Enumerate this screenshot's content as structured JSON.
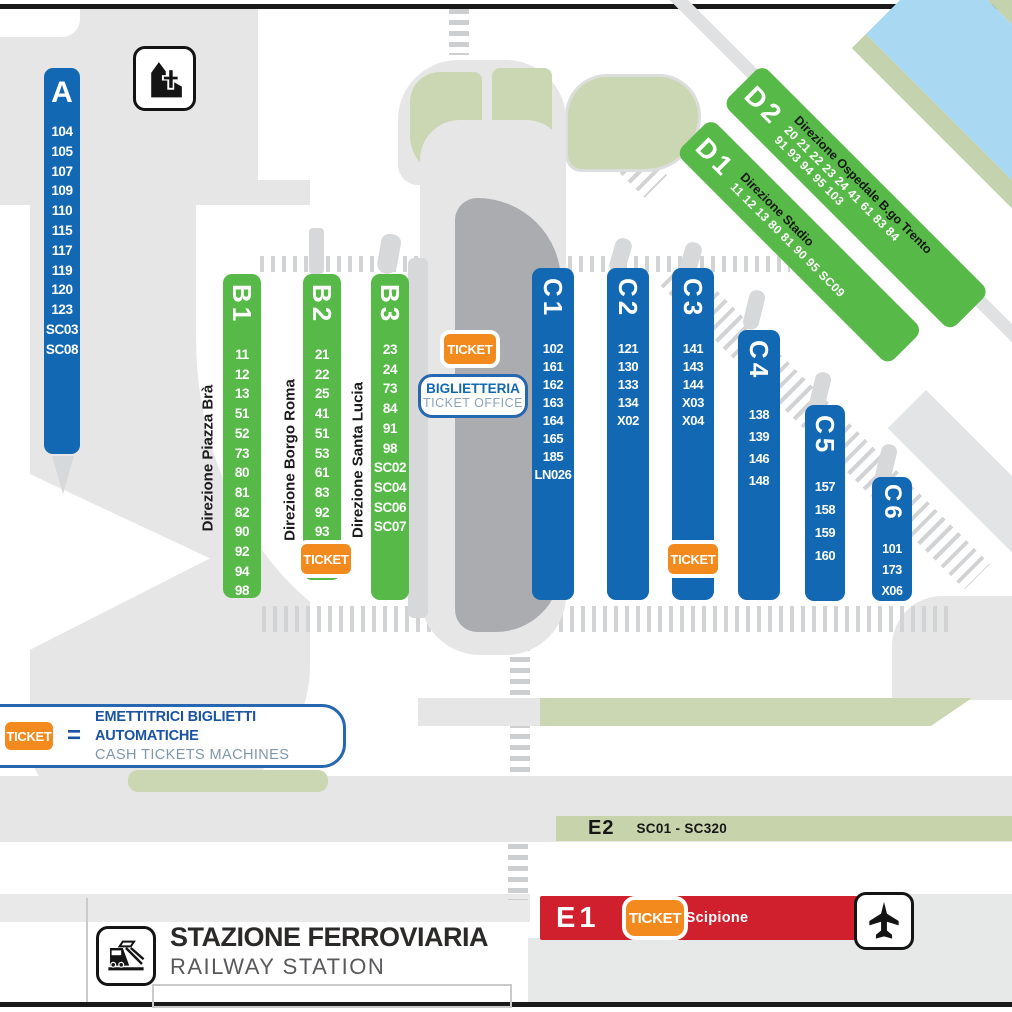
{
  "map_title": "Verona railway station bus platform map",
  "colors": {
    "platform_blue": "#1268b3",
    "platform_green": "#57b947",
    "ticket_orange": "#f28a1e",
    "e1_red": "#d0202e",
    "sage_green": "#cbd7b2",
    "river_blue": "#a9d9f2",
    "road_gray": "#e6e6e7",
    "canopy_gray": "#aaacaf"
  },
  "ticket_badge_label": "TICKET",
  "ticket_office": {
    "line1": "BIGLIETTERIA",
    "line2": "TICKET OFFICE"
  },
  "legend": {
    "badge": "TICKET",
    "equals": "=",
    "line1": "EMETTITRICI BIGLIETTI AUTOMATICHE",
    "line2": "CASH TICKETS MACHINES"
  },
  "station": {
    "title": "STAZIONE FERROVIARIA",
    "subtitle": "RAILWAY STATION"
  },
  "icons": {
    "church": "church-icon",
    "train": "railway-station-icon",
    "airplane": "airport-bus-icon"
  },
  "platforms": {
    "A": {
      "id": "A",
      "numbers": [
        "104",
        "105",
        "107",
        "109",
        "110",
        "115",
        "117",
        "119",
        "120",
        "123",
        "SC03",
        "SC08"
      ]
    },
    "B1": {
      "id": "B1",
      "direction": "Direzione Piazza Brà",
      "numbers": [
        "11",
        "12",
        "13",
        "51",
        "52",
        "73",
        "80",
        "81",
        "82",
        "90",
        "92",
        "94",
        "98"
      ]
    },
    "B2": {
      "id": "B2",
      "direction": "Direzione Borgo Roma",
      "numbers": [
        "21",
        "22",
        "25",
        "41",
        "51",
        "53",
        "61",
        "83",
        "92",
        "93",
        "97"
      ]
    },
    "B3": {
      "id": "B3",
      "direction": "Direzione Santa Lucia",
      "numbers": [
        "23",
        "24",
        "73",
        "84",
        "91",
        "98",
        "SC02",
        "SC04",
        "SC06",
        "SC07"
      ]
    },
    "C1": {
      "id": "C1",
      "numbers": [
        "102",
        "161",
        "162",
        "163",
        "164",
        "165",
        "185",
        "LN026"
      ]
    },
    "C2": {
      "id": "C2",
      "numbers": [
        "121",
        "130",
        "133",
        "134",
        "X02"
      ]
    },
    "C3": {
      "id": "C3",
      "numbers": [
        "141",
        "143",
        "144",
        "X03",
        "X04"
      ]
    },
    "C4": {
      "id": "C4",
      "numbers": [
        "138",
        "139",
        "146",
        "148"
      ]
    },
    "C5": {
      "id": "C5",
      "numbers": [
        "157",
        "158",
        "159",
        "160"
      ]
    },
    "C6": {
      "id": "C6",
      "numbers": [
        "101",
        "173",
        "X06"
      ]
    },
    "D1": {
      "id": "D1",
      "direction": "Direzione Stadio",
      "lines": [
        "11 12 13 80 81 90 95 SC09"
      ]
    },
    "D2": {
      "id": "D2",
      "direction": "Direzione Ospedale B.go Trento",
      "lines": [
        "20 21 22 23 24 41 61 83 84",
        "91 93 94 95 103"
      ]
    },
    "E1": {
      "id": "E1",
      "route": "199 – Scipione"
    },
    "E2": {
      "id": "E2",
      "range": "SC01 - SC320"
    }
  }
}
